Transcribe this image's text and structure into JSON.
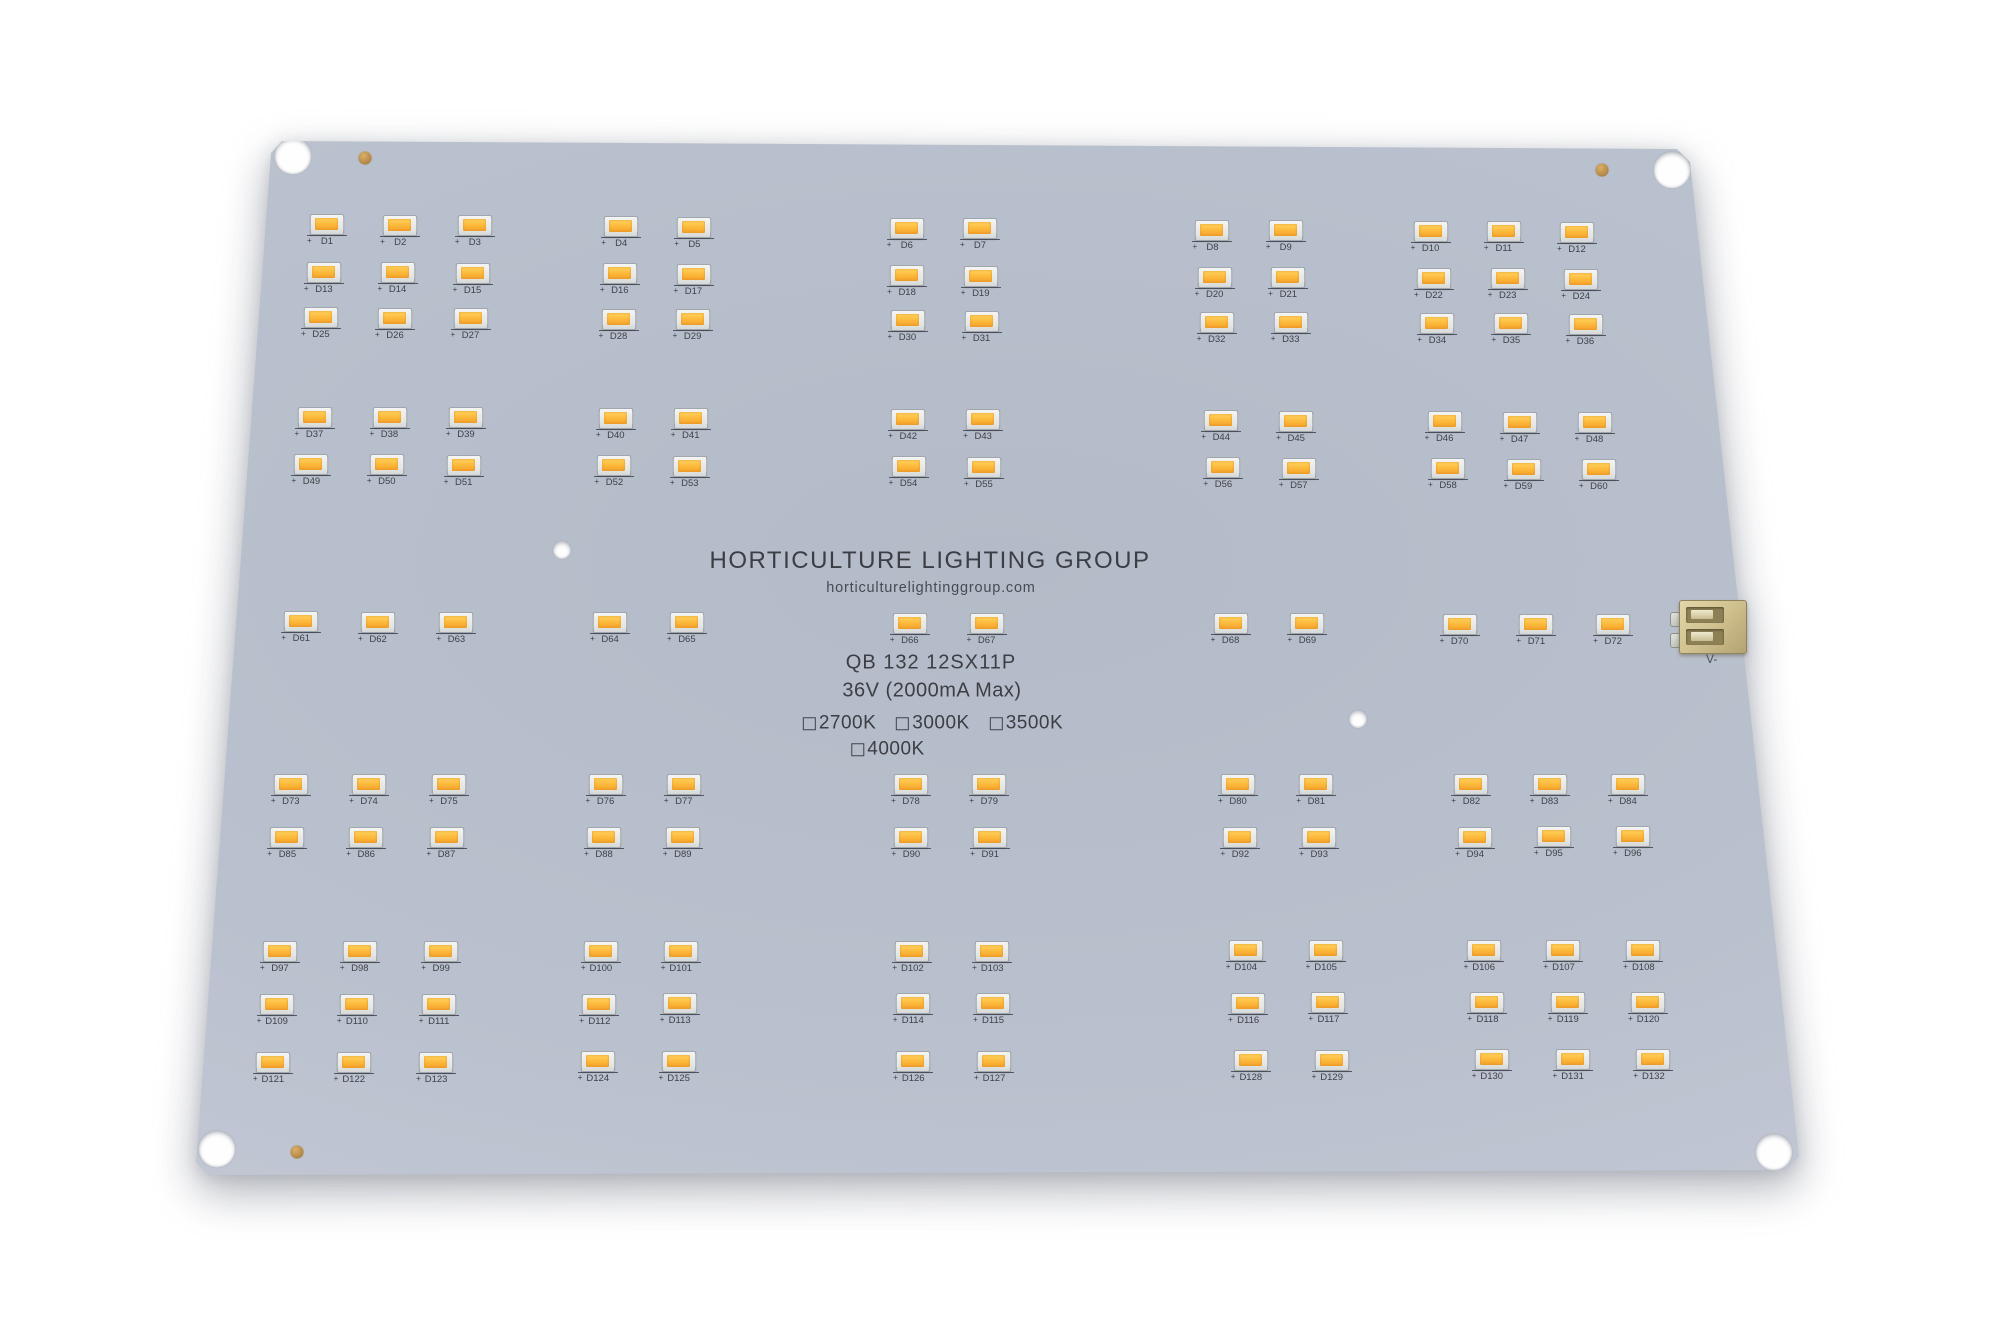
{
  "board": {
    "title": "HORTICULTURE LIGHTING GROUP",
    "website": "horticulturelightinggroup.com",
    "model": "QB 132 12SX11P",
    "voltage_spec": "36V (2000mA Max)",
    "cct_options_line1": [
      "2700K",
      "3000K",
      "3500K"
    ],
    "cct_options_line2": [
      "4000K"
    ],
    "connector_label": "V-",
    "led_polarity_mark": "+",
    "led_count": 132,
    "led_rows": [
      [
        "D1",
        "D2",
        "D3",
        "D4",
        "D5",
        "D6",
        "D7",
        "D8",
        "D9",
        "D10",
        "D11",
        "D12"
      ],
      [
        "D13",
        "D14",
        "D15",
        "D16",
        "D17",
        "D18",
        "D19",
        "D20",
        "D21",
        "D22",
        "D23",
        "D24"
      ],
      [
        "D25",
        "D26",
        "D27",
        "D28",
        "D29",
        "D30",
        "D31",
        "D32",
        "D33",
        "D34",
        "D35",
        "D36"
      ],
      [
        "D37",
        "D38",
        "D39",
        "D40",
        "D41",
        "D42",
        "D43",
        "D44",
        "D45",
        "D46",
        "D47",
        "D48"
      ],
      [
        "D49",
        "D50",
        "D51",
        "D52",
        "D53",
        "D54",
        "D55",
        "D56",
        "D57",
        "D58",
        "D59",
        "D60"
      ],
      [
        "D61",
        "D62",
        "D63",
        "D64",
        "D65",
        "D66",
        "D67",
        "D68",
        "D69",
        "D70",
        "D71",
        "D72"
      ],
      [
        "D73",
        "D74",
        "D75",
        "D76",
        "D77",
        "D78",
        "D79",
        "D80",
        "D81",
        "D82",
        "D83",
        "D84"
      ],
      [
        "D85",
        "D86",
        "D87",
        "D88",
        "D89",
        "D90",
        "D91",
        "D92",
        "D93",
        "D94",
        "D95",
        "D96"
      ],
      [
        "D97",
        "D98",
        "D99",
        "D100",
        "D101",
        "D102",
        "D103",
        "D104",
        "D105",
        "D106",
        "D107",
        "D108"
      ],
      [
        "D109",
        "D110",
        "D111",
        "D112",
        "D113",
        "D114",
        "D115",
        "D116",
        "D117",
        "D118",
        "D119",
        "D120"
      ],
      [
        "D121",
        "D122",
        "D123",
        "D124",
        "D125",
        "D126",
        "D127",
        "D128",
        "D129",
        "D130",
        "D131",
        "D132"
      ]
    ],
    "colors": {
      "background": "#ffffff",
      "board_surface": "#bcc3d0",
      "board_surface_light": "#cdd2dd",
      "led_phosphor": "#fcb83a",
      "led_package": "#ececea",
      "silkscreen_text": "#3b3e44",
      "connector_body": "#d2c391",
      "test_point_gold": "#b98c49"
    }
  }
}
